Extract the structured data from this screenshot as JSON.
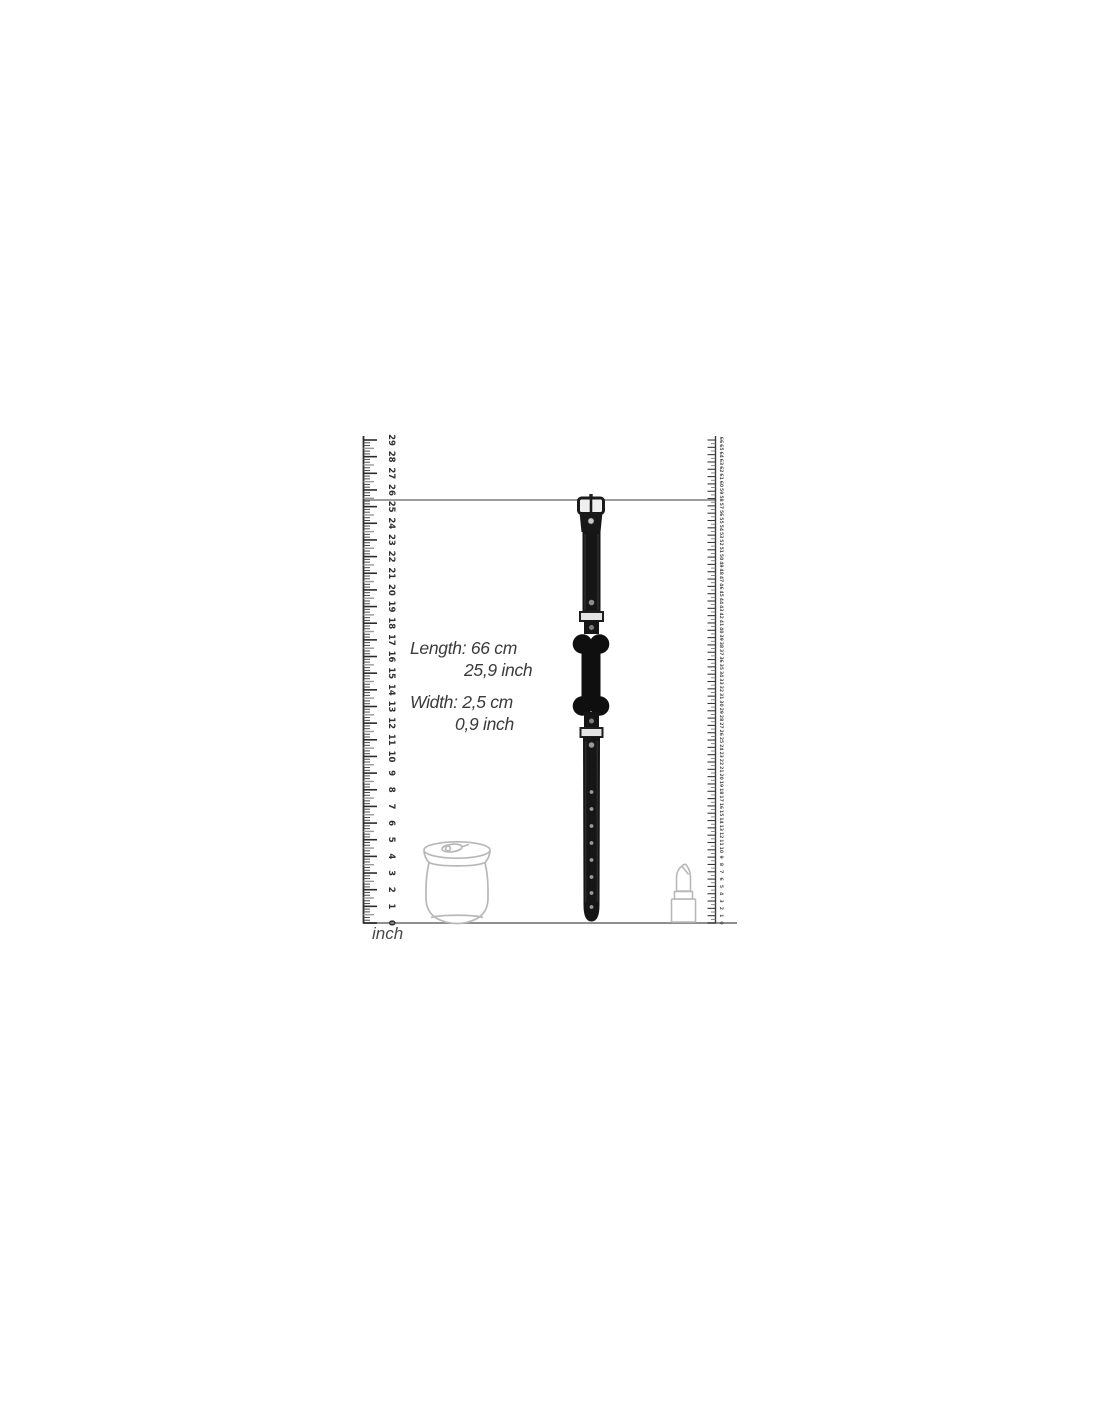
{
  "annotations": {
    "length_line1": "Length: 66 cm",
    "length_line2": "25,9 inch",
    "width_line1": "Width: 2,5 cm",
    "width_line2": "0,9 inch"
  },
  "rulers": {
    "left": {
      "unit_label": "inch",
      "min": 0,
      "max": 29,
      "step": 1,
      "numbers": [
        0,
        1,
        2,
        3,
        4,
        5,
        6,
        7,
        8,
        9,
        10,
        11,
        12,
        13,
        14,
        15,
        16,
        17,
        18,
        19,
        20,
        21,
        22,
        23,
        24,
        25,
        26,
        27,
        28,
        29
      ]
    },
    "right": {
      "unit": "cm",
      "min": 0,
      "max": 66,
      "step": 1
    }
  },
  "colors": {
    "background": "#ffffff",
    "ruler_ink": "#2b2b2b",
    "ruler_half_tick": "#9a9a9a",
    "guide_line": "#8f8f8f",
    "product_black": "#141414",
    "metal_light": "#e4e4e4",
    "rivet": "#9a9a9a",
    "reference_outline": "#b8b8b8",
    "annotation_text": "#3b3b3b"
  }
}
